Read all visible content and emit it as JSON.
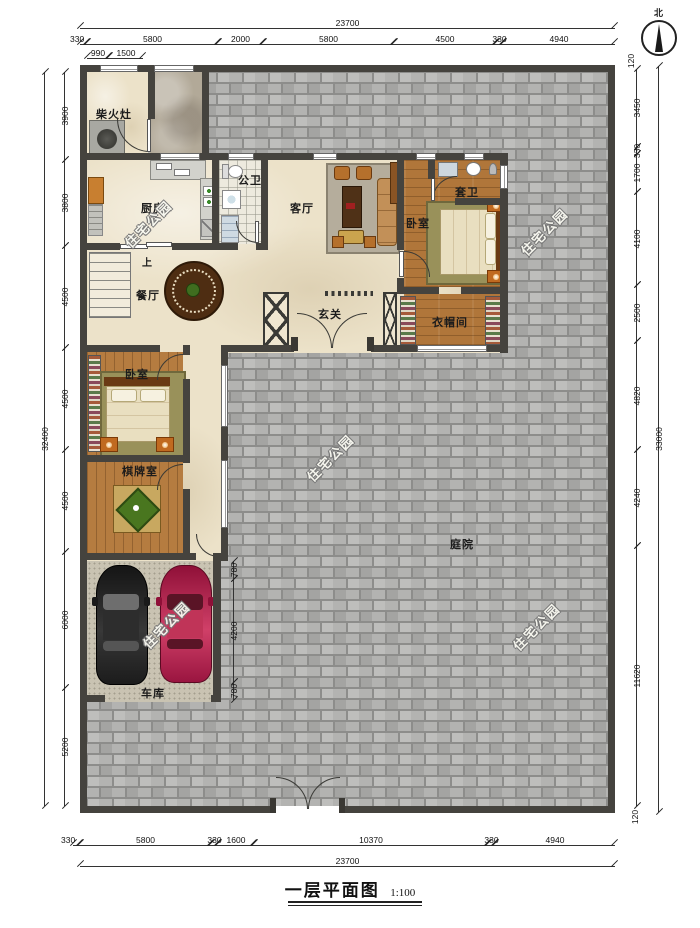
{
  "title": {
    "text": "一层平面图",
    "scale": "1:100"
  },
  "compass": {
    "label": "北"
  },
  "watermark": {
    "text": "住宅公园"
  },
  "rooms": {
    "firewood_stove": "柴火灶",
    "kitchen": "厨房",
    "guest_bath": "公卫",
    "living_room": "客厅",
    "bedroom_1": "卧室",
    "ensuite_bath": "套卫",
    "dining_room": "餐厅",
    "foyer": "玄关",
    "cloakroom": "衣帽间",
    "bedroom_2": "卧室",
    "game_room": "棋牌室",
    "garage": "车库",
    "courtyard": "庭院",
    "stairs_up": "上"
  },
  "dimensions": {
    "top": {
      "total": "23700",
      "segments": [
        "330",
        "5800",
        "2000",
        "5800",
        "4500",
        "330",
        "4940"
      ],
      "sub_segments": [
        "990",
        "1500"
      ]
    },
    "bottom": {
      "total": "23700",
      "segments": [
        "330",
        "5800",
        "330",
        "1600",
        "10370",
        "330",
        "4940"
      ]
    },
    "left": {
      "total": "32400",
      "segments": [
        "3900",
        "3800",
        "4500",
        "4500",
        "4500",
        "6000",
        "5200"
      ]
    },
    "right": {
      "total": "33000",
      "segments": [
        "120",
        "3450",
        "330",
        "1700",
        "4100",
        "2500",
        "4820",
        "4240",
        "11620",
        "120"
      ]
    },
    "garage_door": [
      "780",
      "4200",
      "780"
    ]
  },
  "colors": {
    "wall": "#45433e",
    "brick": "#b3b3b1",
    "floor": "#ece2c9",
    "wood": "#b0763a",
    "accent": "#c06a20"
  }
}
